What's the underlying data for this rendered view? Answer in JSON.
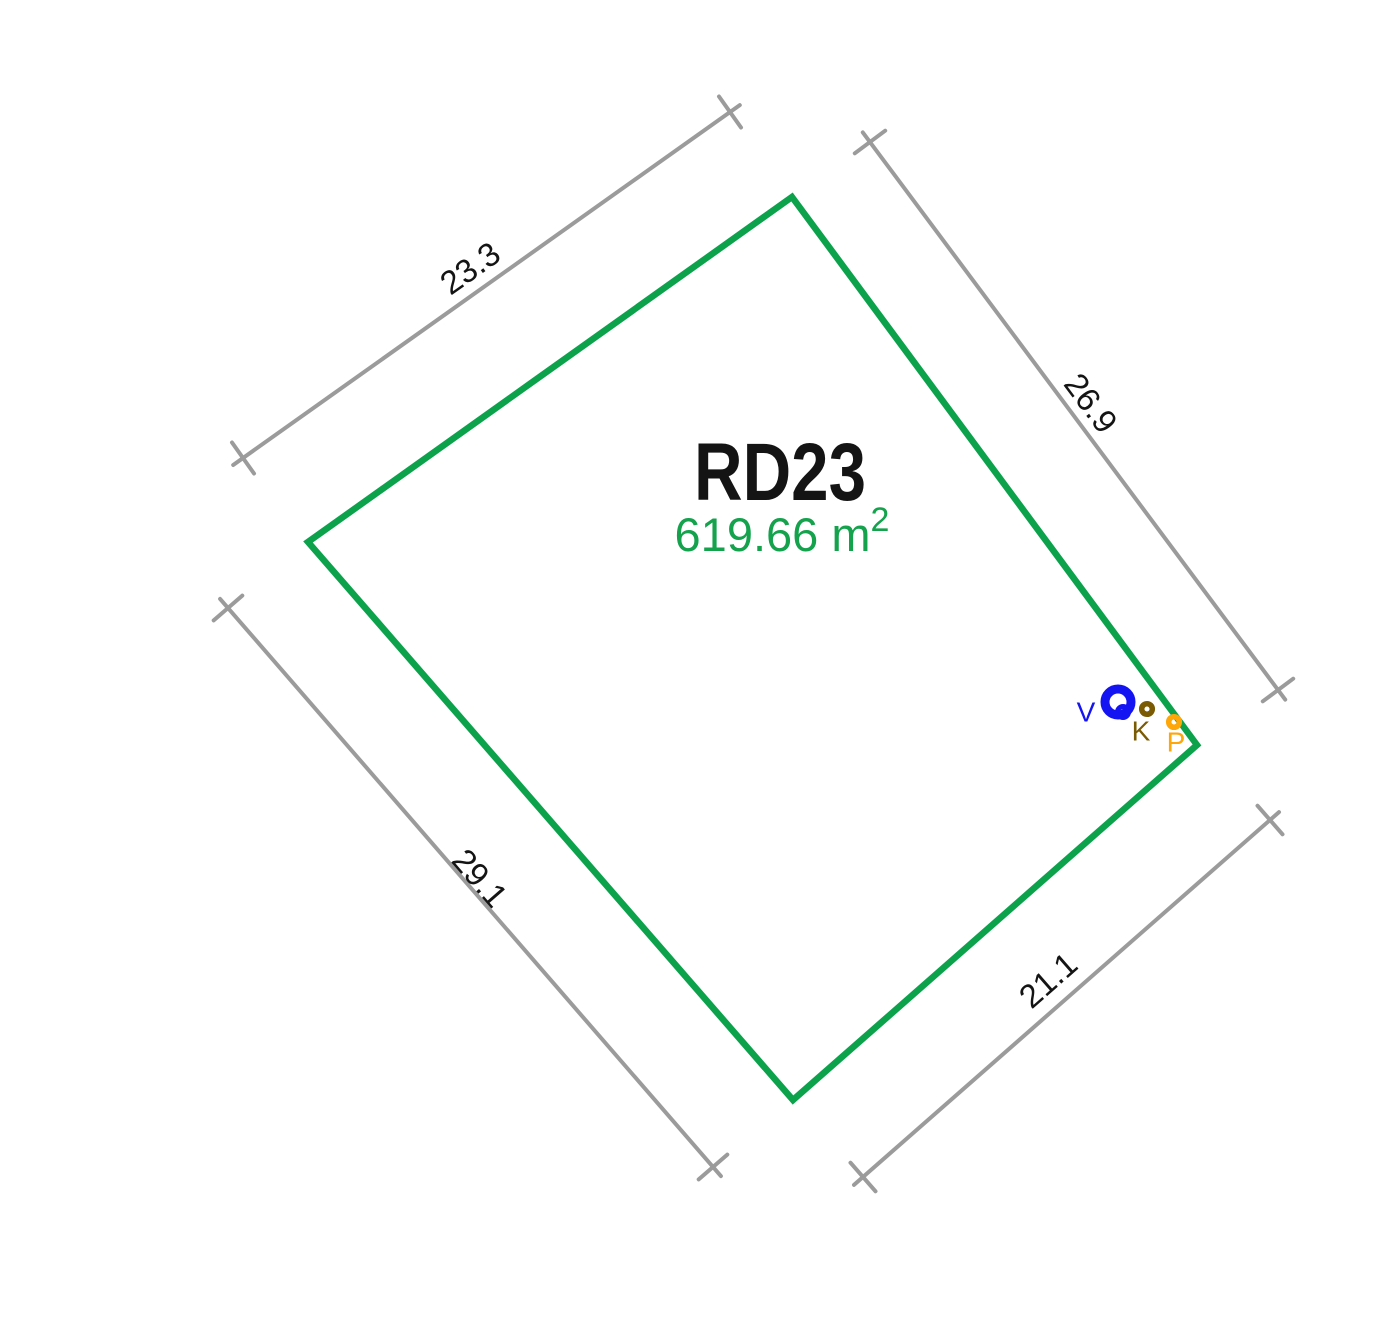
{
  "colors": {
    "boundary_green": "#0ca24c",
    "area_text_green": "#14a24d",
    "dimension_gray": "#9b9b9b",
    "label_black": "#141414",
    "marker_blue": "#1414f2",
    "marker_brown": "#7b5a04",
    "marker_orange": "#ffa608"
  },
  "parcel": {
    "id": "RD23",
    "area_value": "619.66 m",
    "area_superscript": "2"
  },
  "dimensions": {
    "top_left": "23.3",
    "top_right": "26.9",
    "bottom_left": "29.1",
    "bottom_right": "21.1"
  },
  "markers": {
    "v": "V",
    "k": "K",
    "p": "P"
  }
}
